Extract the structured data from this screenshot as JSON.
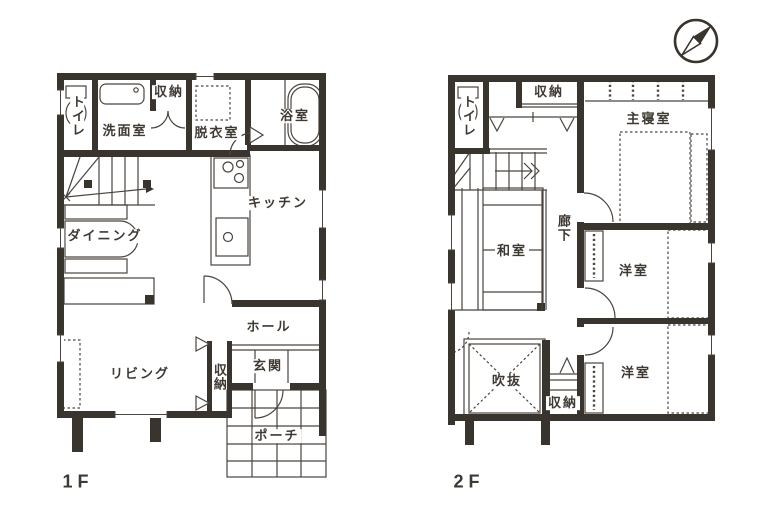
{
  "document": {
    "type": "floor-plan",
    "floors_shown": 2
  },
  "colors": {
    "background": "#ffffff",
    "wall_ink": "#3a342e",
    "line_ink": "#4a443e",
    "text_ink": "#3f3933"
  },
  "icons": {
    "compass": "compass-needle-pointing-northeast"
  },
  "floor1": {
    "label": "1F",
    "rooms": {
      "toilet": "トイレ",
      "washroom": "洗面室",
      "closet_top": "収納",
      "dressing_room": "脱衣室",
      "bathroom": "浴室",
      "kitchen": "キッチン",
      "dining": "ダイニング",
      "hall": "ホール",
      "living": "リビング",
      "closet_entry": "収納",
      "entrance": "玄関",
      "porch": "ポーチ"
    }
  },
  "floor2": {
    "label": "2F",
    "rooms": {
      "toilet": "トイレ",
      "closet_top": "収納",
      "master_bedroom": "主寝室",
      "corridor": "廊下",
      "japanese_room": "和室",
      "western_room_1": "洋室",
      "western_room_2": "洋室",
      "void": "吹抜",
      "closet_bottom": "収納"
    }
  }
}
